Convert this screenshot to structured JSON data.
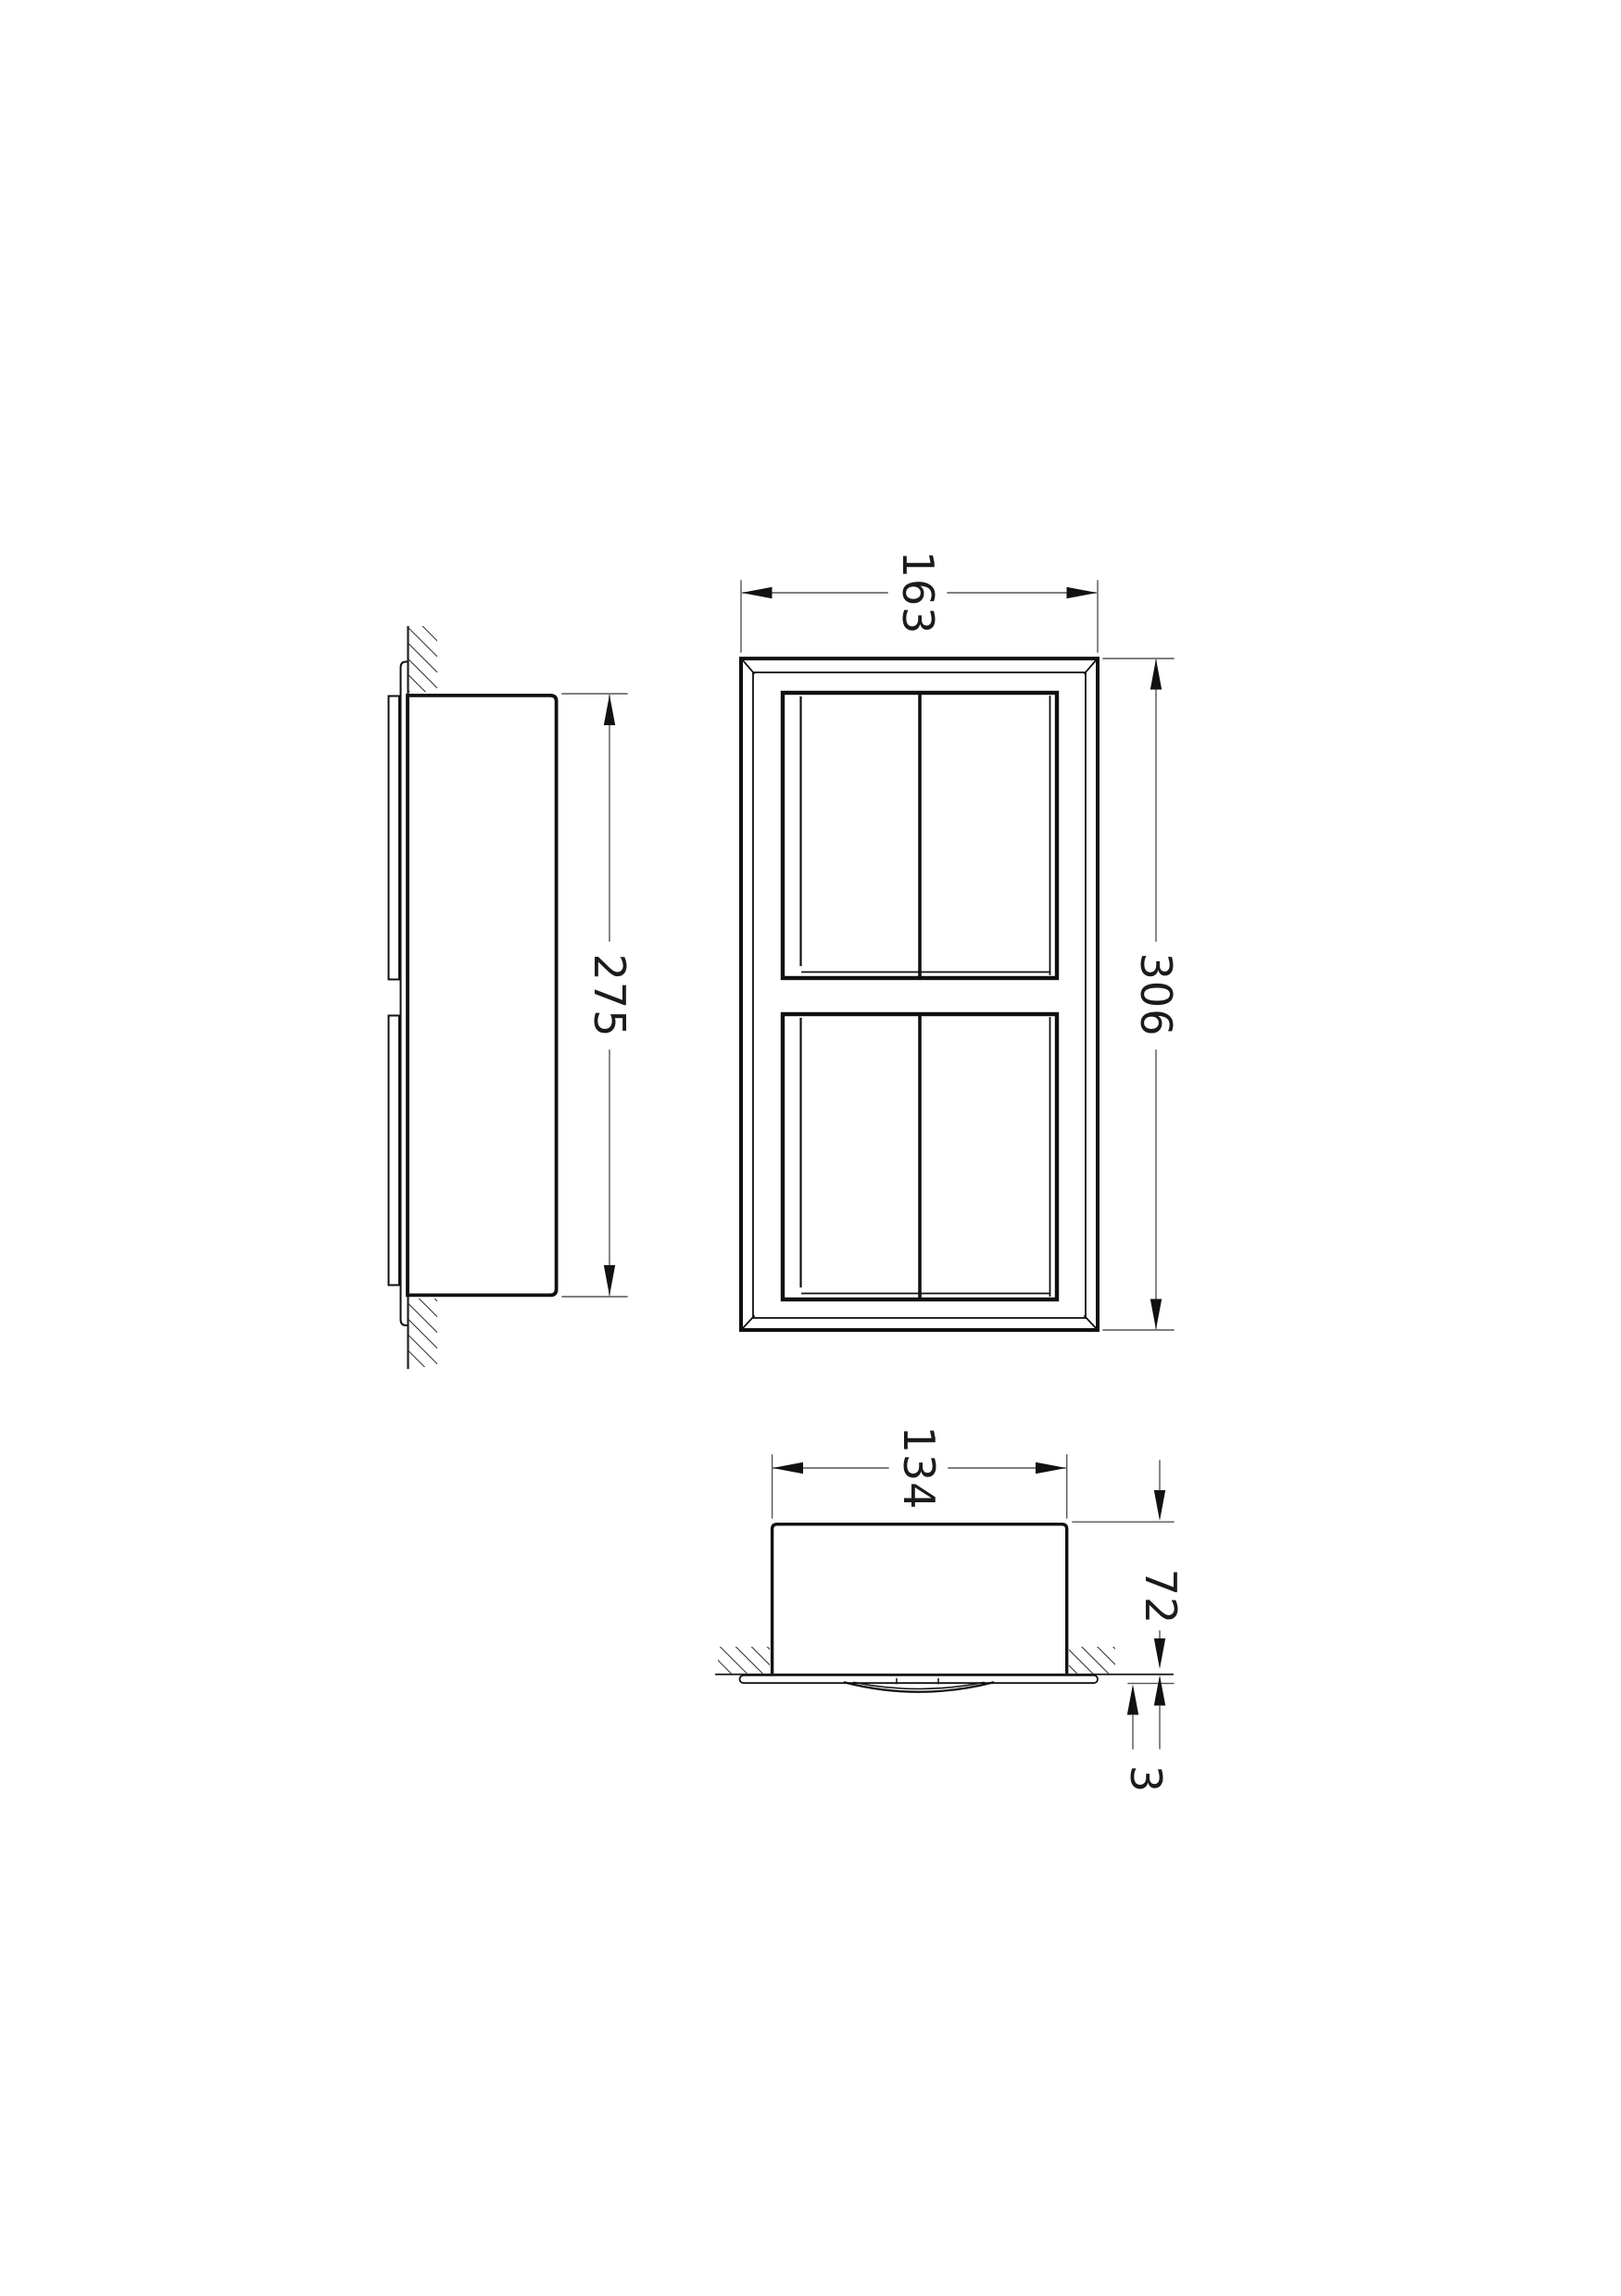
{
  "drawing": {
    "dimensions": {
      "front_width": "163",
      "front_height": "306",
      "side_height": "275",
      "plan_width": "134",
      "plan_depth": "72",
      "plan_protrusion": "3"
    },
    "colors": {
      "outline": "#111111",
      "thin_line": "#333333",
      "dim_line": "#555555",
      "hatch": "#2a2a2a",
      "text": "#1b1b1b",
      "background": "#ffffff"
    }
  }
}
